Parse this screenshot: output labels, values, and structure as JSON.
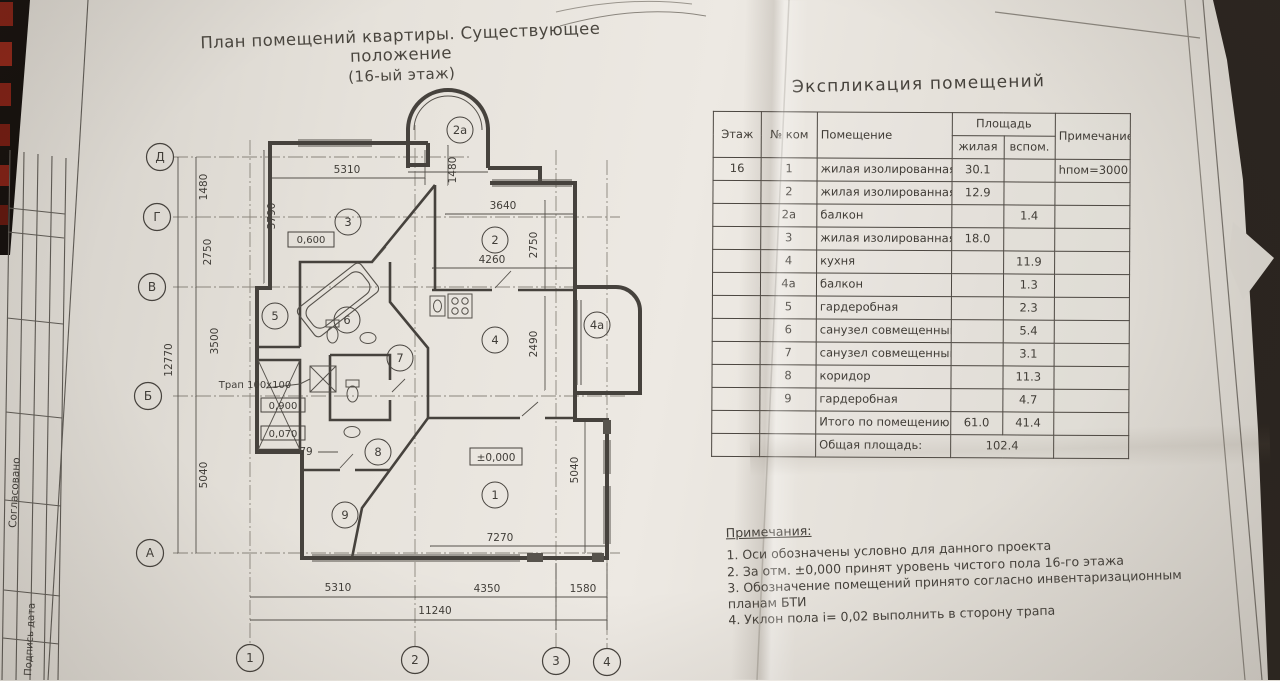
{
  "photo": {
    "desk_color": "#2a241f",
    "paper_color": "#e7e3dd",
    "ink_color": "#46423d",
    "binding_red": "#7d2015"
  },
  "plan_page": {
    "title_line1": "План помещений квартиры. Существующее положение",
    "title_line2": "(16-ый этаж)",
    "stamp": {
      "approved": "Согласовано",
      "sign_date": "Подпись дата"
    },
    "axes": {
      "row_d": "Д",
      "row_g": "Г",
      "row_v": "В",
      "row_b": "Б",
      "row_a": "А",
      "col_1": "1",
      "col_2": "2",
      "col_3": "3",
      "col_4": "4"
    },
    "dims": {
      "left_total": "12770",
      "left_1": "1480",
      "left_2": "2750",
      "left_3": "3500",
      "left_4": "5040",
      "top_width": "5310",
      "top_vert": "1480",
      "room3_depth": "3790",
      "win2": "3640",
      "room2_w": "4260",
      "room2_h": "2750",
      "kitchen_h": "2490",
      "room1_w": "7270",
      "right_h": "5040",
      "bottom_1": "5310",
      "bottom_2": "4350",
      "bottom_3": "1580",
      "bottom_total": "11240",
      "step": "79"
    },
    "levels": {
      "hall": "0,600",
      "bath": "0,900",
      "bath2": "0,070",
      "zero": "±0,000"
    },
    "trap_label": "Трап 100х100",
    "rooms": {
      "r1": "1",
      "r2": "2",
      "r2a": "2а",
      "r3": "3",
      "r4": "4",
      "r4a": "4а",
      "r5": "5",
      "r6": "6",
      "r7": "7",
      "r8": "8",
      "r9": "9"
    }
  },
  "table_page": {
    "title": "Экспликация помещений",
    "headers": {
      "floor": "Этаж",
      "num": "№ ком",
      "room": "Помещение",
      "area": "Площадь",
      "living": "жилая",
      "aux": "вспом.",
      "note": "Примечание"
    },
    "rows": [
      {
        "floor": "16",
        "num": "1",
        "room": "жилая изолированная",
        "living": "30.1",
        "aux": "",
        "note": "hпом=3000"
      },
      {
        "floor": "",
        "num": "2",
        "room": "жилая изолированная",
        "living": "12.9",
        "aux": "",
        "note": ""
      },
      {
        "floor": "",
        "num": "2а",
        "room": "балкон",
        "living": "",
        "aux": "1.4",
        "note": ""
      },
      {
        "floor": "",
        "num": "3",
        "room": "жилая изолированная",
        "living": "18.0",
        "aux": "",
        "note": ""
      },
      {
        "floor": "",
        "num": "4",
        "room": "кухня",
        "living": "",
        "aux": "11.9",
        "note": ""
      },
      {
        "floor": "",
        "num": "4а",
        "room": "балкон",
        "living": "",
        "aux": "1.3",
        "note": ""
      },
      {
        "floor": "",
        "num": "5",
        "room": "гардеробная",
        "living": "",
        "aux": "2.3",
        "note": ""
      },
      {
        "floor": "",
        "num": "6",
        "room": "санузел совмещенный",
        "living": "",
        "aux": "5.4",
        "note": ""
      },
      {
        "floor": "",
        "num": "7",
        "room": "санузел совмещенный",
        "living": "",
        "aux": "3.1",
        "note": ""
      },
      {
        "floor": "",
        "num": "8",
        "room": "коридор",
        "living": "",
        "aux": "11.3",
        "note": ""
      },
      {
        "floor": "",
        "num": "9",
        "room": "гардеробная",
        "living": "",
        "aux": "4.7",
        "note": ""
      }
    ],
    "totals": {
      "label": "Итого по помещению:",
      "living": "61.0",
      "aux": "41.4"
    },
    "grand": {
      "label": "Общая площадь:",
      "value": "102.4"
    },
    "notes": {
      "title": "Примечания:",
      "n1": "1. Оси обозначены условно для данного проекта",
      "n2": "2. За отм. ±0,000 принят уровень чистого пола 16-го этажа",
      "n3": "3. Обозначение помещений принято согласно инвентаризационным планам БТИ",
      "n4": "4. Уклон пола i= 0,02 выполнить в сторону трапа"
    }
  }
}
